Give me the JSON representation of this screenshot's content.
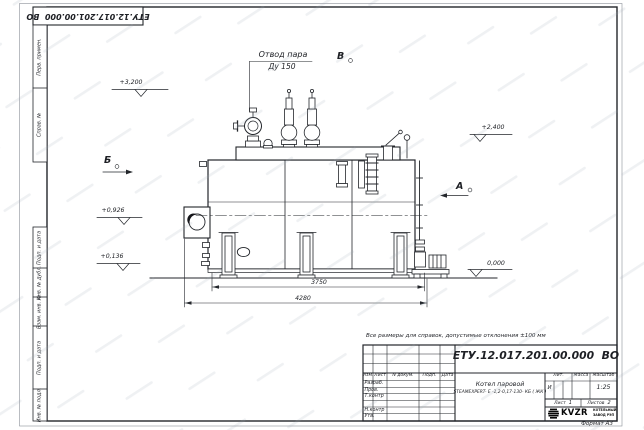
{
  "sheet": {
    "stamp_top": "ЕТУ.12.017.201.00.000  ВО",
    "note": "Все размеры для справок, допустимые отклонения ±100 мм",
    "format_label": "Формат А3"
  },
  "side_columns": [
    "Перв. примен.",
    "Справ. №",
    "Подп. и дата",
    "Инв. № дубл.",
    "Взам. инв. №",
    "Подп. и дата",
    "Инв. № подл."
  ],
  "drawing": {
    "callout_line1": "Отвод пара",
    "callout_line2": "Ду 150",
    "view_a": "А",
    "view_b": "Б",
    "view_v": "В",
    "elev_3200": "+3,200",
    "elev_2400": "+2,400",
    "elev_0926": "+0,926",
    "elev_0136": "+0,136",
    "elev_0000": "0,000",
    "dim_3750": "3750",
    "dim_4280": "4280"
  },
  "title_block": {
    "doc_number": "ЕТУ.12.017.201.00.000  ВО",
    "product_line1": "Котел паровой",
    "product_line2": "STEAMEXPERT- Е -1,2-0,17-130- КБ ( ЖК )",
    "col_izm": "Изм.",
    "col_list": "Лист",
    "col_ndoc": "N докум.",
    "col_podp": "Подп.",
    "col_data": "Дата",
    "rows": [
      "Разраб.",
      "Пров.",
      "Т.контр",
      "Н.контр",
      "Утв."
    ],
    "lit_label": "Лит.",
    "lit_value": "И",
    "mass_label": "Масса",
    "scale_label": "Масштаб",
    "scale_value": "1:25",
    "sheet_label": "Лист",
    "sheet_value": "1",
    "sheets_label": "Листов",
    "sheets_value": "2",
    "logo_text": "KVZR",
    "logo_caption1": "КОТЕЛЬНЫЙ",
    "logo_caption2": "ЗАВОД РЭП"
  }
}
